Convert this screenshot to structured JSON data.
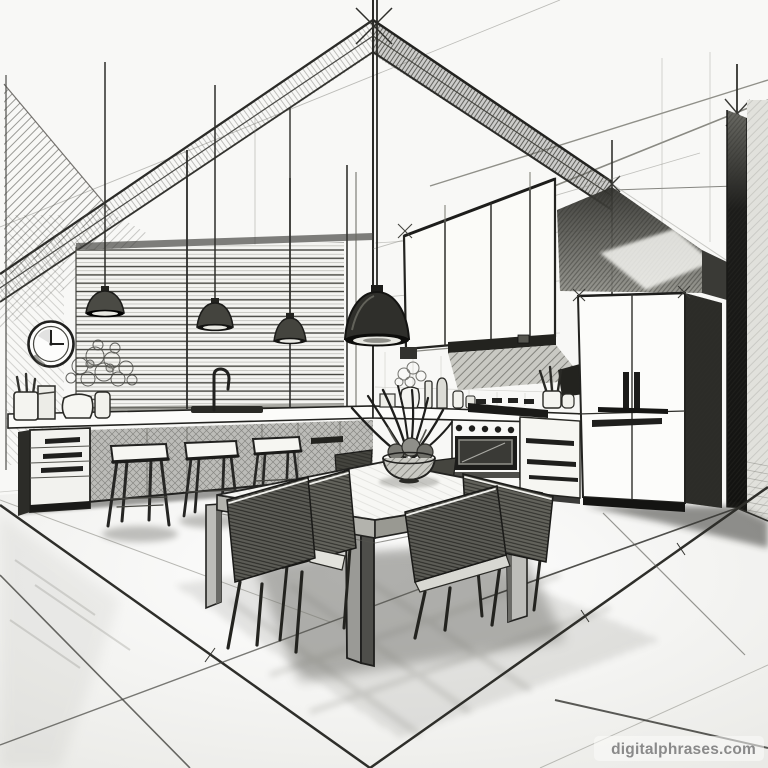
{
  "meta": {
    "title": "Pencil sketch of a modern kitchen interior",
    "style": "two-point perspective concept sketch, graphite linework on white paper",
    "canvas": "768x768",
    "palette": {
      "paper": "#f8f8f6",
      "ink_dark": "#1f1f1d",
      "ink_mid": "#55554f",
      "ink_light": "#9a9a94",
      "shadow": "#2c2c28"
    }
  },
  "watermark": {
    "text": "digitalphrases.com",
    "color": "#8a8a8a"
  },
  "scene": {
    "objects": [
      {
        "name": "ceiling-construction-lines",
        "label": "Two-point perspective ceiling edges with crossed construction marks"
      },
      {
        "name": "wall-clock",
        "label": "Round wall clock showing 3:00"
      },
      {
        "name": "window-blinds",
        "label": "Wide window covered by horizontal venetian blinds"
      },
      {
        "name": "pendant-lights",
        "label": "Four dome pendant lamps hanging on long cords",
        "count": 4
      },
      {
        "name": "kitchen-counter",
        "label": "Long island counter with drawer unit, sink and gooseneck faucet"
      },
      {
        "name": "bar-stools",
        "label": "Three wooden bar stools at the counter",
        "count": 3
      },
      {
        "name": "counter-props",
        "label": "Flower vases, bottles, utensil crocks and a small carton on the counters"
      },
      {
        "name": "upper-cabinets",
        "label": "Wall cabinets above the cooking range"
      },
      {
        "name": "range-hood",
        "label": "Range hood beneath the wall cabinets"
      },
      {
        "name": "stove-oven",
        "label": "Gas cooktop with control knobs and oven window"
      },
      {
        "name": "drawer-cabinet",
        "label": "Cabinet with three long-handled drawers beside the stove"
      },
      {
        "name": "refrigerator",
        "label": "French-door refrigerator with darkly shaded side panel"
      },
      {
        "name": "dining-table",
        "label": "Square dining table on thick corner posts"
      },
      {
        "name": "dining-chairs",
        "label": "Six hatched dining chairs around the table",
        "count": 6
      },
      {
        "name": "table-centerpiece",
        "label": "Fruit bowl and spiky leafy plant on the tabletop"
      },
      {
        "name": "tiled-floor",
        "label": "Glossy tiled floor with perspective guide lines and soft cast shadows"
      }
    ]
  }
}
